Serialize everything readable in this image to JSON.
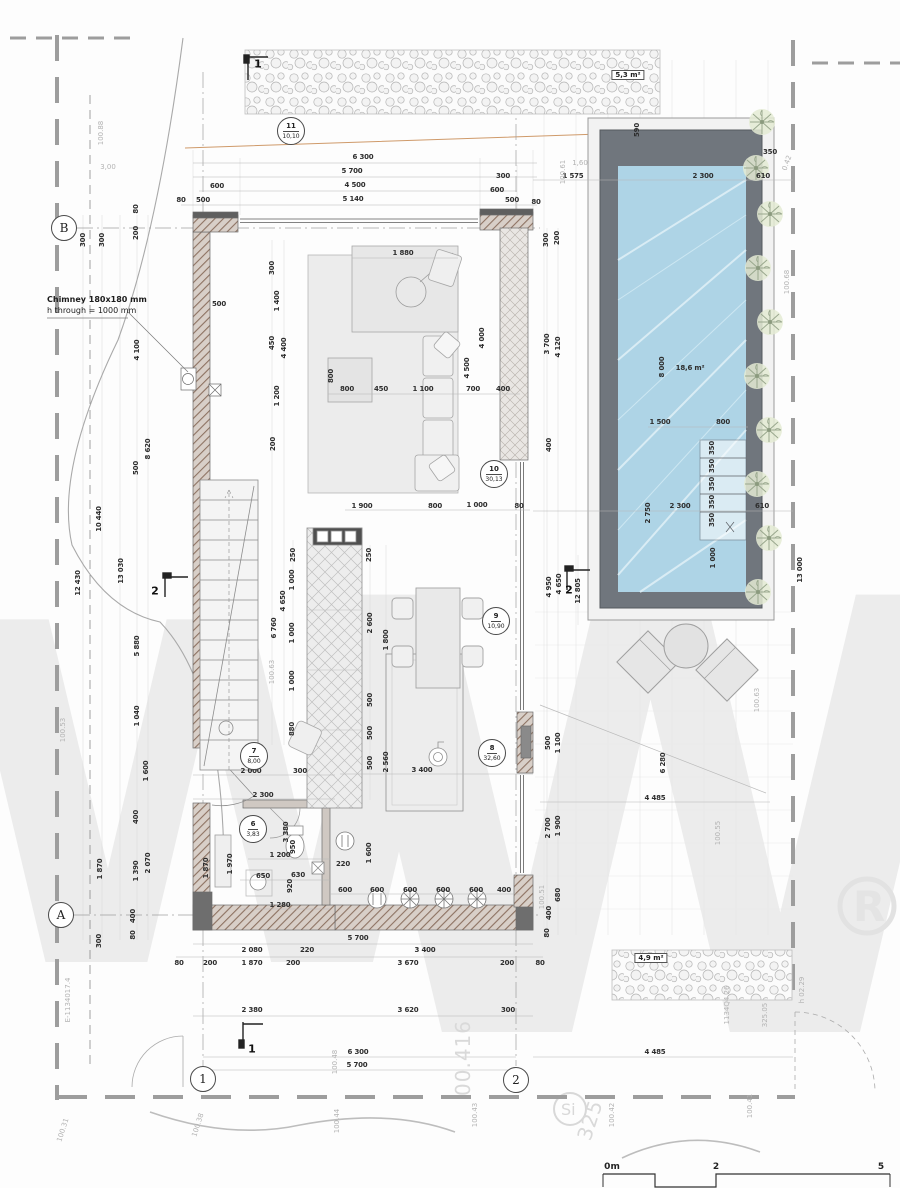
{
  "meta": {
    "drawing_type": "ground floor plan with pool",
    "units": "mm",
    "scale_units": "m"
  },
  "note": {
    "line1": "Chimney 180x180 mm",
    "line2": "h through = 1000 mm"
  },
  "watermark": {
    "letter1": "W",
    "letter2": "W",
    "reg": "R",
    "si": "Si"
  },
  "colors": {
    "pool_water": "#aed4e6",
    "pool_deck": "#70767d",
    "wall_hatch": "#8d7262",
    "plant": "#9aa88e",
    "watermark": "#ececec",
    "dim_text": "#2e2e2e",
    "level_text": "#b3b3b3"
  },
  "areas": [
    {
      "t": "5,3 m²",
      "x": 628,
      "y": 75
    },
    {
      "t": "4,9 m²",
      "x": 651,
      "y": 958
    }
  ],
  "pool_label": {
    "t": "18,6 m²",
    "x": 690,
    "y": 368
  },
  "rooms": [
    {
      "num": "11",
      "area": "10,10",
      "x": 291,
      "y": 131
    },
    {
      "num": "10",
      "area": "30,13",
      "x": 494,
      "y": 474
    },
    {
      "num": "9",
      "area": "10,90",
      "x": 496,
      "y": 621
    },
    {
      "num": "8",
      "area": "32,60",
      "x": 492,
      "y": 753
    },
    {
      "num": "7",
      "area": "8,00",
      "x": 254,
      "y": 756
    },
    {
      "num": "6",
      "area": "3,83",
      "x": 253,
      "y": 829
    }
  ],
  "grids": [
    {
      "t": "B",
      "x": 64,
      "y": 228
    },
    {
      "t": "A",
      "x": 61,
      "y": 915
    },
    {
      "t": "1",
      "x": 203,
      "y": 1079
    },
    {
      "t": "2",
      "x": 516,
      "y": 1080
    }
  ],
  "sections": [
    {
      "t": "1",
      "x": 258,
      "y": 64
    },
    {
      "t": "1",
      "x": 252,
      "y": 1049
    },
    {
      "t": "2",
      "x": 155,
      "y": 591
    },
    {
      "t": "2",
      "x": 569,
      "y": 590
    }
  ],
  "scale": {
    "labels": [
      {
        "t": "0m",
        "x": 612,
        "y": 1172
      },
      {
        "t": "2",
        "x": 716,
        "y": 1172
      },
      {
        "t": "5",
        "x": 881,
        "y": 1172
      }
    ]
  },
  "dims": [
    {
      "t": "6 300",
      "x": 363,
      "y": 157
    },
    {
      "t": "5 700",
      "x": 352,
      "y": 171
    },
    {
      "t": "4 500",
      "x": 355,
      "y": 185
    },
    {
      "t": "5 140",
      "x": 353,
      "y": 199
    },
    {
      "t": "300",
      "x": 503,
      "y": 176
    },
    {
      "t": "600",
      "x": 497,
      "y": 190
    },
    {
      "t": "500",
      "x": 512,
      "y": 200
    },
    {
      "t": "80",
      "x": 536,
      "y": 202
    },
    {
      "t": "600",
      "x": 217,
      "y": 186
    },
    {
      "t": "500",
      "x": 203,
      "y": 200
    },
    {
      "t": "80",
      "x": 181,
      "y": 200
    },
    {
      "t": "1 575",
      "x": 573,
      "y": 176
    },
    {
      "t": "2 300",
      "x": 703,
      "y": 176
    },
    {
      "t": "610",
      "x": 763,
      "y": 176
    },
    {
      "t": "350",
      "x": 770,
      "y": 152
    },
    {
      "t": "590",
      "x": 637,
      "y": 130,
      "r": -90
    },
    {
      "t": "300",
      "x": 83,
      "y": 240,
      "r": -90
    },
    {
      "t": "300",
      "x": 102,
      "y": 240,
      "r": -90
    },
    {
      "t": "200",
      "x": 136,
      "y": 233,
      "r": -90
    },
    {
      "t": "80",
      "x": 136,
      "y": 209,
      "r": -90
    },
    {
      "t": "4 100",
      "x": 137,
      "y": 350,
      "r": -90
    },
    {
      "t": "500",
      "x": 136,
      "y": 468,
      "r": -90
    },
    {
      "t": "8 620",
      "x": 148,
      "y": 449,
      "r": -90
    },
    {
      "t": "10 440",
      "x": 99,
      "y": 519,
      "r": -90
    },
    {
      "t": "12 430",
      "x": 78,
      "y": 583,
      "r": -90
    },
    {
      "t": "13 030",
      "x": 121,
      "y": 571,
      "r": -90
    },
    {
      "t": "5 880",
      "x": 137,
      "y": 646,
      "r": -90
    },
    {
      "t": "1 040",
      "x": 137,
      "y": 716,
      "r": -90
    },
    {
      "t": "1 600",
      "x": 146,
      "y": 771,
      "r": -90
    },
    {
      "t": "400",
      "x": 136,
      "y": 817,
      "r": -90
    },
    {
      "t": "1 870",
      "x": 100,
      "y": 869,
      "r": -90
    },
    {
      "t": "1 390",
      "x": 136,
      "y": 871,
      "r": -90
    },
    {
      "t": "2 070",
      "x": 148,
      "y": 863,
      "r": -90
    },
    {
      "t": "300",
      "x": 99,
      "y": 941,
      "r": -90
    },
    {
      "t": "80",
      "x": 133,
      "y": 935,
      "r": -90
    },
    {
      "t": "400",
      "x": 133,
      "y": 916,
      "r": -90
    },
    {
      "t": "1 870",
      "x": 206,
      "y": 868,
      "r": -90
    },
    {
      "t": "1 970",
      "x": 230,
      "y": 864,
      "r": -90
    },
    {
      "t": "500",
      "x": 219,
      "y": 304
    },
    {
      "t": "300",
      "x": 272,
      "y": 268,
      "r": -90
    },
    {
      "t": "1 400",
      "x": 277,
      "y": 301,
      "r": -90
    },
    {
      "t": "450",
      "x": 272,
      "y": 343,
      "r": -90
    },
    {
      "t": "4 400",
      "x": 284,
      "y": 348,
      "r": -90
    },
    {
      "t": "1 200",
      "x": 277,
      "y": 396,
      "r": -90
    },
    {
      "t": "200",
      "x": 273,
      "y": 444,
      "r": -90
    },
    {
      "t": "250",
      "x": 293,
      "y": 555,
      "r": -90
    },
    {
      "t": "1 000",
      "x": 292,
      "y": 580,
      "r": -90
    },
    {
      "t": "4 650",
      "x": 283,
      "y": 601,
      "r": -90
    },
    {
      "t": "6 760",
      "x": 274,
      "y": 628,
      "r": -90
    },
    {
      "t": "1 000",
      "x": 292,
      "y": 633,
      "r": -90
    },
    {
      "t": "1 000",
      "x": 292,
      "y": 681,
      "r": -90
    },
    {
      "t": "880",
      "x": 292,
      "y": 729,
      "r": -90
    },
    {
      "t": "1 880",
      "x": 403,
      "y": 253
    },
    {
      "t": "800",
      "x": 347,
      "y": 389
    },
    {
      "t": "450",
      "x": 381,
      "y": 389
    },
    {
      "t": "1 100",
      "x": 423,
      "y": 389
    },
    {
      "t": "700",
      "x": 473,
      "y": 389
    },
    {
      "t": "400",
      "x": 503,
      "y": 389
    },
    {
      "t": "800",
      "x": 331,
      "y": 376,
      "r": -90
    },
    {
      "t": "4 500",
      "x": 467,
      "y": 368,
      "r": -90
    },
    {
      "t": "4 000",
      "x": 482,
      "y": 338,
      "r": -90
    },
    {
      "t": "3 700",
      "x": 547,
      "y": 344,
      "r": -90
    },
    {
      "t": "4 120",
      "x": 558,
      "y": 347,
      "r": -90
    },
    {
      "t": "300",
      "x": 546,
      "y": 240,
      "r": -90
    },
    {
      "t": "200",
      "x": 557,
      "y": 238,
      "r": -90
    },
    {
      "t": "400",
      "x": 549,
      "y": 445,
      "r": -90
    },
    {
      "t": "1 900",
      "x": 362,
      "y": 506
    },
    {
      "t": "800",
      "x": 435,
      "y": 506
    },
    {
      "t": "1 000",
      "x": 477,
      "y": 505
    },
    {
      "t": "80",
      "x": 519,
      "y": 506
    },
    {
      "t": "250",
      "x": 369,
      "y": 555,
      "r": -90
    },
    {
      "t": "2 600",
      "x": 370,
      "y": 623,
      "r": -90
    },
    {
      "t": "1 800",
      "x": 386,
      "y": 640,
      "r": -90
    },
    {
      "t": "500",
      "x": 370,
      "y": 700,
      "r": -90
    },
    {
      "t": "500",
      "x": 370,
      "y": 733,
      "r": -90
    },
    {
      "t": "500",
      "x": 370,
      "y": 763,
      "r": -90
    },
    {
      "t": "2 560",
      "x": 386,
      "y": 762,
      "r": -90
    },
    {
      "t": "3 400",
      "x": 422,
      "y": 770
    },
    {
      "t": "2 000",
      "x": 251,
      "y": 771
    },
    {
      "t": "300",
      "x": 300,
      "y": 771
    },
    {
      "t": "2 300",
      "x": 263,
      "y": 795
    },
    {
      "t": "1 200",
      "x": 280,
      "y": 855
    },
    {
      "t": "650",
      "x": 263,
      "y": 876
    },
    {
      "t": "630",
      "x": 298,
      "y": 875
    },
    {
      "t": "920",
      "x": 290,
      "y": 886,
      "r": -90
    },
    {
      "t": "1 280",
      "x": 280,
      "y": 905
    },
    {
      "t": "220",
      "x": 343,
      "y": 864
    },
    {
      "t": "950",
      "x": 293,
      "y": 847,
      "r": -90
    },
    {
      "t": "3 380",
      "x": 286,
      "y": 832,
      "r": -90
    },
    {
      "t": "4 950",
      "x": 549,
      "y": 587,
      "r": -90
    },
    {
      "t": "4 650",
      "x": 559,
      "y": 584,
      "r": -90
    },
    {
      "t": "12 805",
      "x": 578,
      "y": 591,
      "r": -90
    },
    {
      "t": "500",
      "x": 548,
      "y": 743,
      "r": -90
    },
    {
      "t": "1 100",
      "x": 558,
      "y": 743,
      "r": -90
    },
    {
      "t": "6 280",
      "x": 663,
      "y": 763,
      "r": -90
    },
    {
      "t": "4 485",
      "x": 655,
      "y": 798
    },
    {
      "t": "2 700",
      "x": 548,
      "y": 828,
      "r": -90
    },
    {
      "t": "1 900",
      "x": 558,
      "y": 826,
      "r": -90
    },
    {
      "t": "680",
      "x": 558,
      "y": 895,
      "r": -90
    },
    {
      "t": "400",
      "x": 549,
      "y": 913,
      "r": -90
    },
    {
      "t": "80",
      "x": 547,
      "y": 933,
      "r": -90
    },
    {
      "t": "8 000",
      "x": 662,
      "y": 367,
      "r": -90
    },
    {
      "t": "1 500",
      "x": 660,
      "y": 422
    },
    {
      "t": "800",
      "x": 723,
      "y": 422
    },
    {
      "t": "2 300",
      "x": 680,
      "y": 506
    },
    {
      "t": "2 750",
      "x": 648,
      "y": 513,
      "r": -90
    },
    {
      "t": "610",
      "x": 762,
      "y": 506
    },
    {
      "t": "1 000",
      "x": 713,
      "y": 558,
      "r": -90
    },
    {
      "t": "350",
      "x": 712,
      "y": 448,
      "r": -90
    },
    {
      "t": "350",
      "x": 712,
      "y": 466,
      "r": -90
    },
    {
      "t": "350",
      "x": 712,
      "y": 484,
      "r": -90
    },
    {
      "t": "350",
      "x": 712,
      "y": 502,
      "r": -90
    },
    {
      "t": "350",
      "x": 712,
      "y": 520,
      "r": -90
    },
    {
      "t": "13 000",
      "x": 800,
      "y": 570,
      "r": -90
    },
    {
      "t": "600",
      "x": 345,
      "y": 890
    },
    {
      "t": "600",
      "x": 377,
      "y": 890
    },
    {
      "t": "600",
      "x": 410,
      "y": 890
    },
    {
      "t": "600",
      "x": 443,
      "y": 890
    },
    {
      "t": "600",
      "x": 476,
      "y": 890
    },
    {
      "t": "400",
      "x": 504,
      "y": 890
    },
    {
      "t": "1 600",
      "x": 369,
      "y": 853,
      "r": -90
    },
    {
      "t": "5 700",
      "x": 358,
      "y": 938
    },
    {
      "t": "2 080",
      "x": 252,
      "y": 950
    },
    {
      "t": "220",
      "x": 307,
      "y": 950
    },
    {
      "t": "3 400",
      "x": 425,
      "y": 950
    },
    {
      "t": "80",
      "x": 179,
      "y": 963
    },
    {
      "t": "200",
      "x": 210,
      "y": 963
    },
    {
      "t": "1 870",
      "x": 252,
      "y": 963
    },
    {
      "t": "200",
      "x": 293,
      "y": 963
    },
    {
      "t": "3 670",
      "x": 408,
      "y": 963
    },
    {
      "t": "200",
      "x": 507,
      "y": 963
    },
    {
      "t": "80",
      "x": 540,
      "y": 963
    },
    {
      "t": "2 380",
      "x": 252,
      "y": 1010
    },
    {
      "t": "3 620",
      "x": 408,
      "y": 1010
    },
    {
      "t": "300",
      "x": 508,
      "y": 1010
    },
    {
      "t": "6 300",
      "x": 358,
      "y": 1052
    },
    {
      "t": "5 700",
      "x": 357,
      "y": 1065
    },
    {
      "t": "4 485",
      "x": 655,
      "y": 1052
    }
  ],
  "levels": [
    {
      "t": "100.61",
      "x": 563,
      "y": 172,
      "r": -90
    },
    {
      "t": "1,60",
      "x": 580,
      "y": 163
    },
    {
      "t": "100.88",
      "x": 101,
      "y": 133,
      "r": -90
    },
    {
      "t": "3,00",
      "x": 108,
      "y": 167
    },
    {
      "t": "100.63",
      "x": 272,
      "y": 672,
      "r": -90
    },
    {
      "t": "100.63",
      "x": 757,
      "y": 700,
      "r": -90
    },
    {
      "t": "100.68",
      "x": 787,
      "y": 282,
      "r": -90
    },
    {
      "t": "0.42",
      "x": 787,
      "y": 163,
      "r": -70
    },
    {
      "t": "100.53",
      "x": 63,
      "y": 730,
      "r": -90
    },
    {
      "t": "100.55",
      "x": 718,
      "y": 833,
      "r": -90
    },
    {
      "t": "100.51",
      "x": 542,
      "y": 897,
      "r": -90
    },
    {
      "t": "100.48",
      "x": 335,
      "y": 1062,
      "r": -90
    },
    {
      "t": "100.44",
      "x": 337,
      "y": 1121,
      "r": -90
    },
    {
      "t": "100.43",
      "x": 475,
      "y": 1115,
      "r": -90
    },
    {
      "t": "100.38",
      "x": 198,
      "y": 1125,
      "r": -72
    },
    {
      "t": "100.31",
      "x": 63,
      "y": 1130,
      "r": -72
    },
    {
      "t": "100.42",
      "x": 612,
      "y": 1115,
      "r": -90
    },
    {
      "t": "100.41",
      "x": 750,
      "y": 1106,
      "r": -90
    },
    {
      "t": "325.05",
      "x": 765,
      "y": 1015,
      "r": -90
    },
    {
      "t": "E-1134017.4",
      "x": 68,
      "y": 1000,
      "r": -90
    },
    {
      "t": "1134Q4.26",
      "x": 727,
      "y": 1005,
      "r": -90
    },
    {
      "t": "h 02.29",
      "x": 802,
      "y": 990,
      "r": -90
    },
    {
      "t": "00.416",
      "x": 463,
      "y": 1058,
      "r": -90,
      "big": true
    },
    {
      "t": "325",
      "x": 590,
      "y": 1120,
      "r": -72,
      "big": true
    }
  ]
}
